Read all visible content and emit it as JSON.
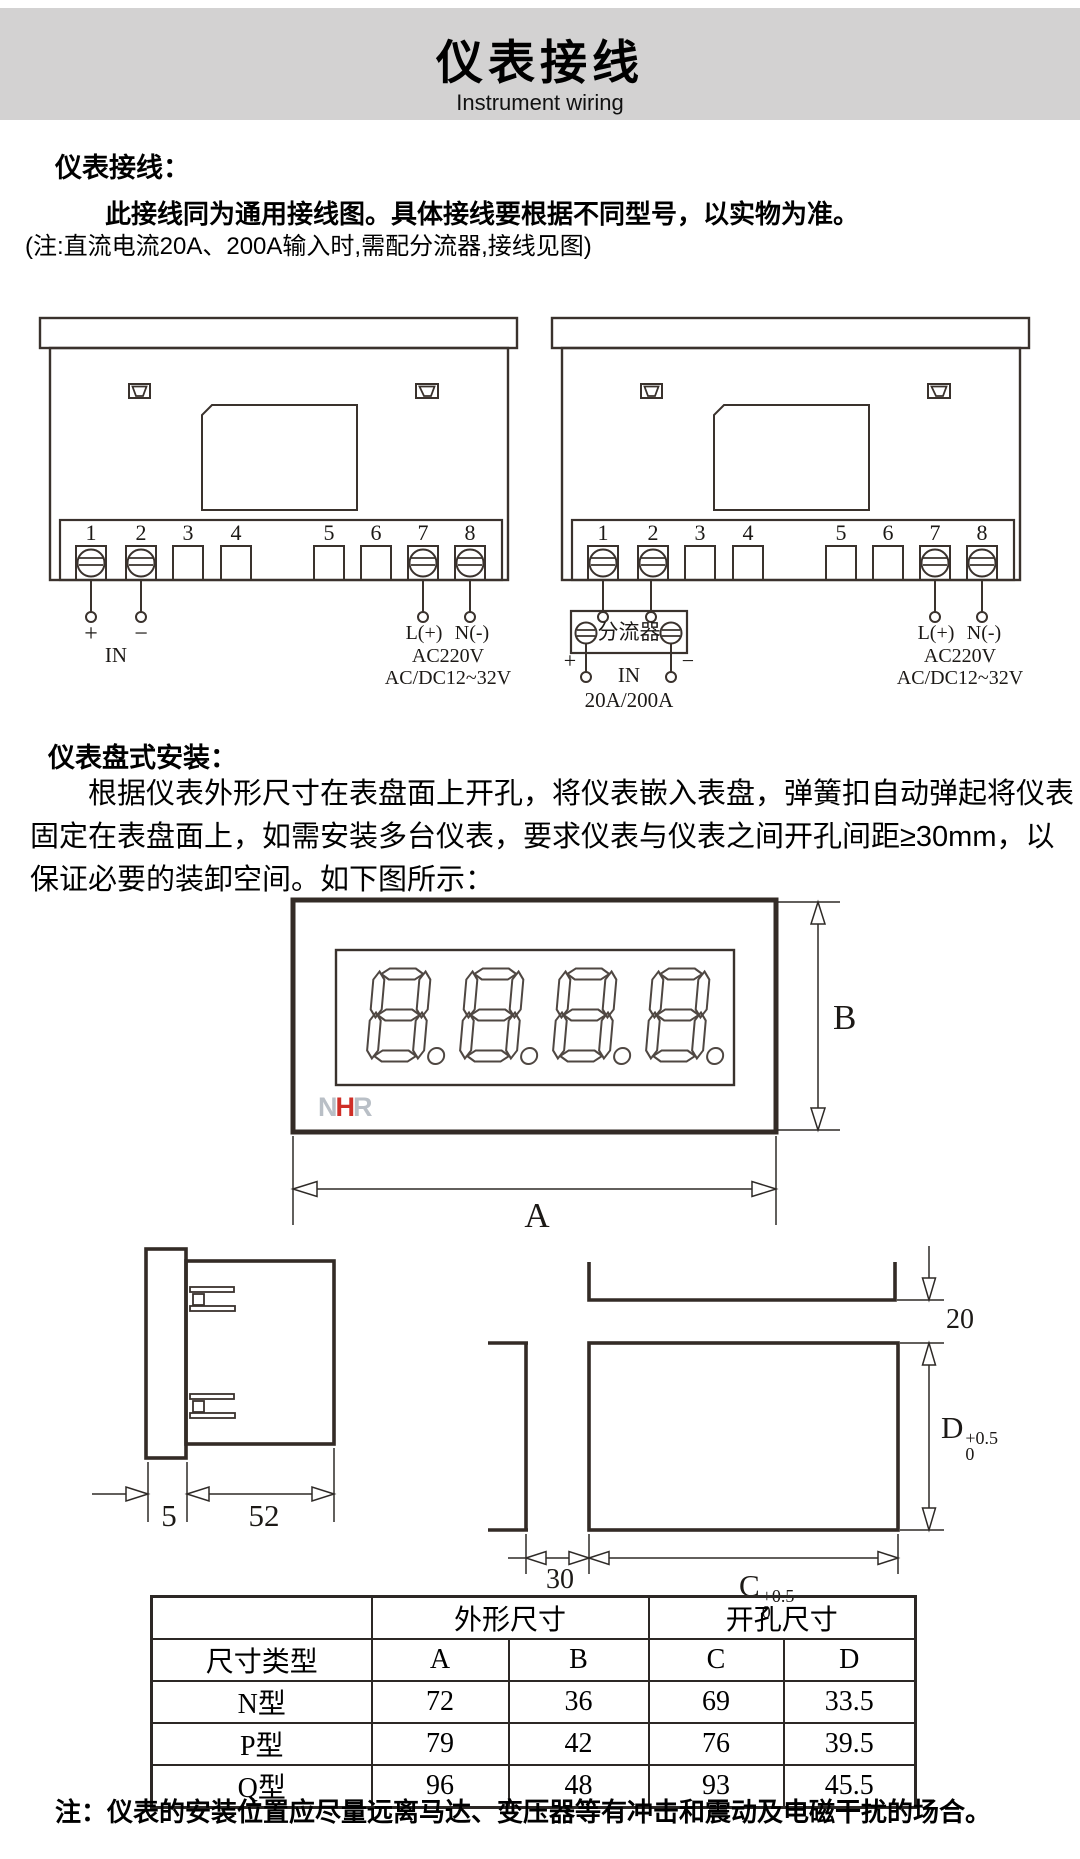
{
  "header": {
    "title": "仪表接线",
    "subtitle": "Instrument wiring"
  },
  "wiring_section": {
    "heading": "仪表接线：",
    "intro_bold": "此接线同为通用接线图。具体接线要根据不同型号，以实物为准。",
    "note": "(注:直流电流20A、200A输入时,需配分流器,接线见图)",
    "terminal_numbers": [
      "1",
      "2",
      "3",
      "4",
      "5",
      "6",
      "7",
      "8"
    ],
    "input_labels": {
      "plus": "+",
      "minus": "−",
      "in": "IN"
    },
    "psu_labels": {
      "l": "L(+)",
      "n": "N(-)",
      "ac": "AC220V",
      "acdc": "AC/DC12~32V"
    },
    "shunt": {
      "name": "分流器",
      "plus": "+",
      "minus": "−",
      "in": "IN",
      "range": "20A/200A"
    }
  },
  "mount_section": {
    "heading": "仪表盘式安装：",
    "para_line1": "根据仪表外形尺寸在表盘面上开孔，将仪表嵌入表盘，弹簧扣自动弹起将仪表",
    "para_line2": "固定在表盘面上，如需安装多台仪表，要求仪表与仪表之间开孔间距≥30mm，以",
    "para_line3": "保证必要的装卸空间。如下图所示："
  },
  "meter_figure": {
    "logo_n": "N",
    "logo_h": "H",
    "logo_r": "R",
    "dim_a": "A",
    "dim_b": "B"
  },
  "side_figure": {
    "dim_5": "5",
    "dim_52": "52",
    "dim_30": "30",
    "dim_20": "20",
    "dim_c": "C",
    "dim_d": "D",
    "tol_sup": "+0.5",
    "tol_sub": "0"
  },
  "table": {
    "group_outer": "外形尺寸",
    "group_cutout": "开孔尺寸",
    "col_type": "尺寸类型",
    "col_a": "A",
    "col_b": "B",
    "col_c": "C",
    "col_d": "D",
    "rows": [
      {
        "type": "N型",
        "a": "72",
        "b": "36",
        "c": "69",
        "d": "33.5"
      },
      {
        "type": "P型",
        "a": "79",
        "b": "42",
        "c": "76",
        "d": "39.5"
      },
      {
        "type": "Q型",
        "a": "96",
        "b": "48",
        "c": "93",
        "d": "45.5"
      }
    ]
  },
  "footer_note": "注：仪表的安装位置应尽量远离马达、变压器等有冲击和震动及电磁干扰的场合。"
}
